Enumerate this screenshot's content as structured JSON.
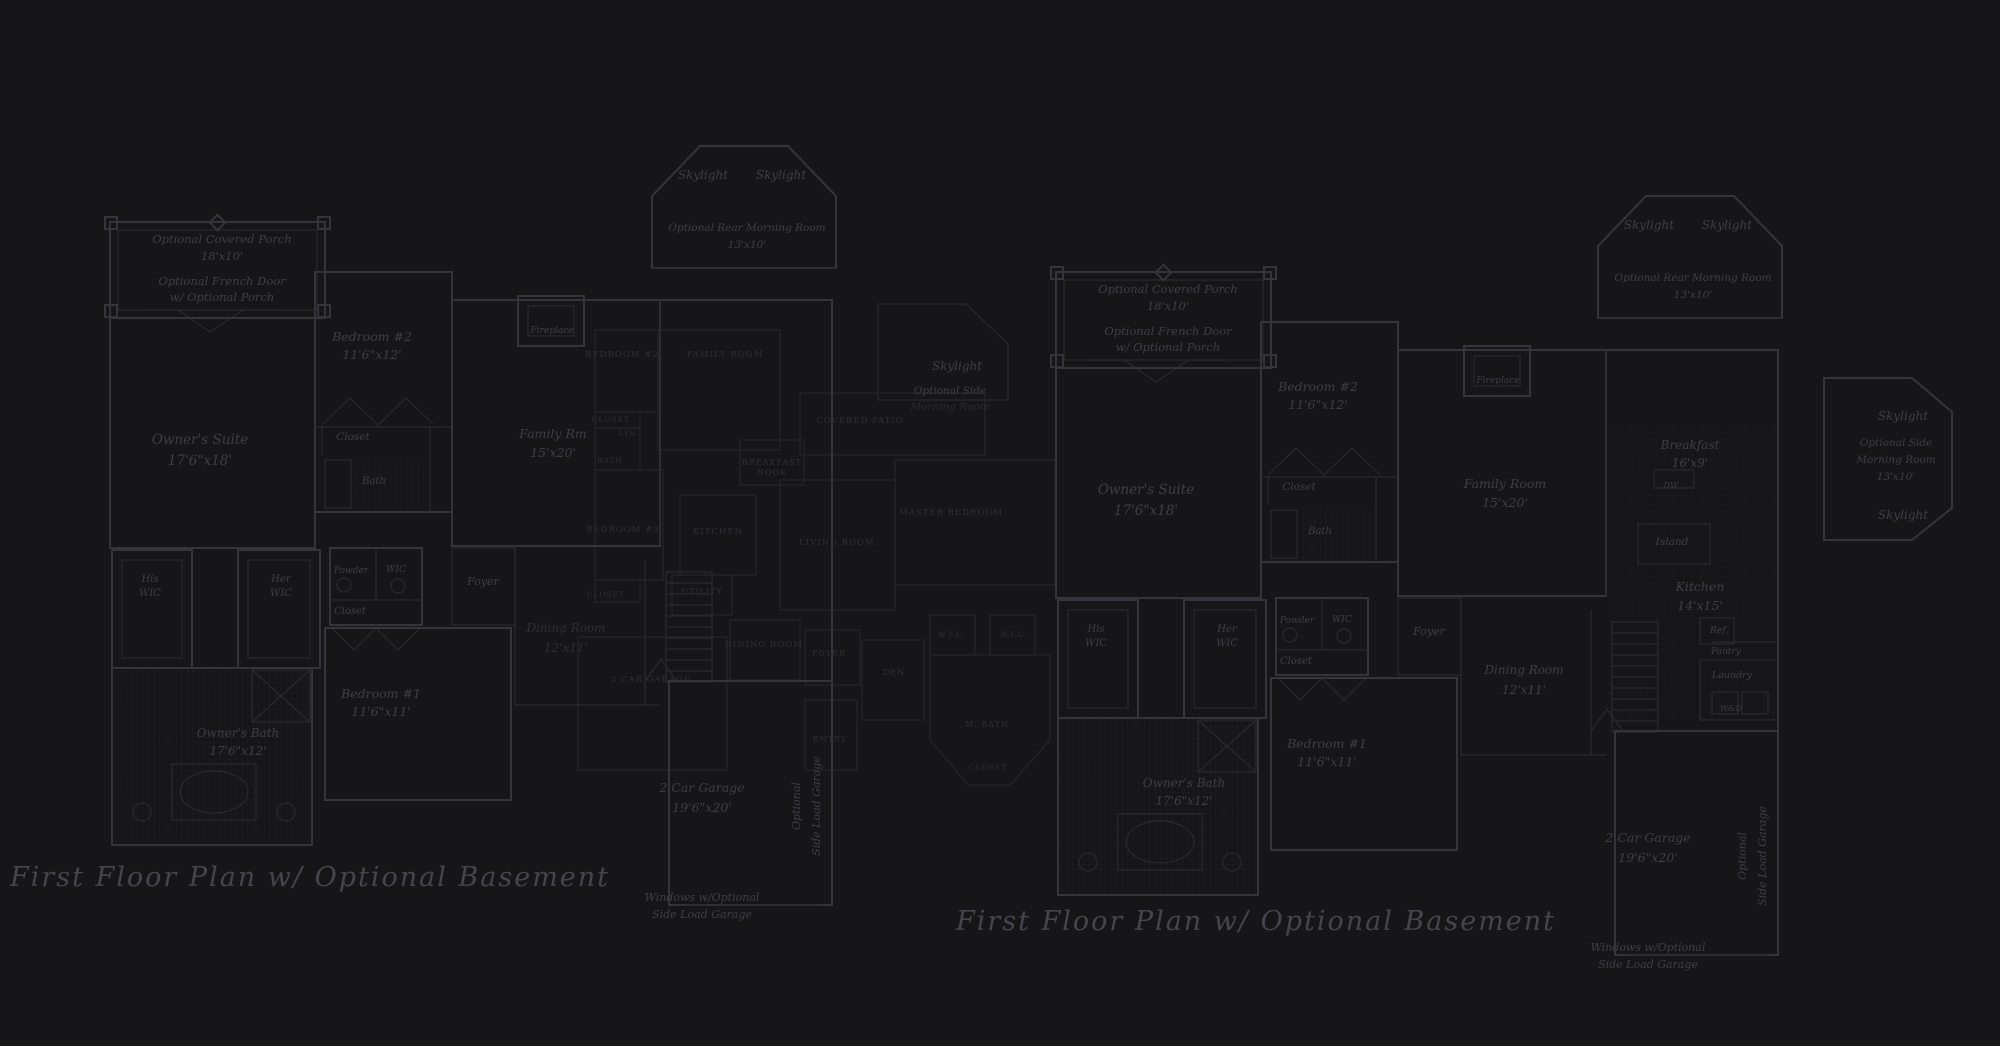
{
  "colors": {
    "background": "#161618",
    "wall": "#34343a",
    "thin": "#2a2a2e",
    "grid": "#222226",
    "bgline": "#26262b",
    "bgtext": "#32323a",
    "label": "#3f3e46",
    "caption": "#46454e"
  },
  "plans": {
    "left": {
      "caption": "First Floor Plan  w/ Optional Basement",
      "labels": [
        {
          "name": "optional-covered-porch-line1",
          "text": "Optional Covered Porch",
          "x": 222,
          "y": 243,
          "size": 11.5
        },
        {
          "name": "optional-covered-porch-line2",
          "text": "18'x10'",
          "x": 222,
          "y": 260,
          "size": 11.5
        },
        {
          "name": "optional-french-door-line1",
          "text": "Optional French Door",
          "x": 222,
          "y": 285,
          "size": 11.5
        },
        {
          "name": "optional-french-door-line2",
          "text": "w/ Optional Porch",
          "x": 222,
          "y": 301,
          "size": 11.5
        },
        {
          "name": "bedroom-2-line1",
          "text": "Bedroom #2",
          "x": 372,
          "y": 341,
          "size": 12.5
        },
        {
          "name": "bedroom-2-line2",
          "text": "11'6\"x12'",
          "x": 372,
          "y": 359,
          "size": 12.5
        },
        {
          "name": "owners-suite-line1",
          "text": "Owner's Suite",
          "x": 200,
          "y": 444,
          "size": 13.5
        },
        {
          "name": "owners-suite-line2",
          "text": "17'6\"x18'",
          "x": 200,
          "y": 465,
          "size": 13.5
        },
        {
          "name": "closet-bedroom2",
          "text": "Closet",
          "x": 353,
          "y": 440,
          "size": 10.5
        },
        {
          "name": "bath-bedroom2",
          "text": "Bath",
          "x": 374,
          "y": 484,
          "size": 10
        },
        {
          "name": "family-rm-line1",
          "text": "Family Rm",
          "x": 553,
          "y": 438,
          "size": 12.5
        },
        {
          "name": "family-rm-line2",
          "text": "15'x20'",
          "x": 553,
          "y": 457,
          "size": 12.5
        },
        {
          "name": "fireplace",
          "text": "Fireplace",
          "x": 552,
          "y": 333,
          "size": 9
        },
        {
          "name": "skylight-rear-left",
          "text": "Skylight",
          "x": 703,
          "y": 179,
          "size": 12
        },
        {
          "name": "skylight-rear-right",
          "text": "Skylight",
          "x": 781,
          "y": 179,
          "size": 12
        },
        {
          "name": "optional-rear-morning-room-line1",
          "text": "Optional Rear Morning Room",
          "x": 747,
          "y": 231,
          "size": 10.5
        },
        {
          "name": "optional-rear-morning-room-line2",
          "text": "13'x10'",
          "x": 747,
          "y": 248,
          "size": 10.5
        },
        {
          "name": "skylight-side",
          "text": "Skylight",
          "x": 957,
          "y": 370,
          "size": 12
        },
        {
          "name": "optional-side-morning-room-line1",
          "text": "Optional Side",
          "x": 950,
          "y": 394,
          "size": 10.5
        },
        {
          "name": "optional-side-morning-room-line2",
          "text": "Morning Room",
          "x": 950,
          "y": 410,
          "size": 10.5,
          "opacity": 0.5
        },
        {
          "name": "his-wic-line1",
          "text": "His",
          "x": 150,
          "y": 582,
          "size": 10
        },
        {
          "name": "his-wic-line2",
          "text": "WIC",
          "x": 150,
          "y": 596,
          "size": 10
        },
        {
          "name": "her-wic-line1",
          "text": "Her",
          "x": 281,
          "y": 582,
          "size": 10
        },
        {
          "name": "her-wic-line2",
          "text": "WIC",
          "x": 281,
          "y": 596,
          "size": 10
        },
        {
          "name": "powder",
          "text": "Powder",
          "x": 351,
          "y": 573,
          "size": 9
        },
        {
          "name": "wic-hall",
          "text": "WIC",
          "x": 396,
          "y": 572,
          "size": 9
        },
        {
          "name": "closet-hall",
          "text": "Closet",
          "x": 350,
          "y": 614,
          "size": 10
        },
        {
          "name": "foyer",
          "text": "Foyer",
          "x": 483,
          "y": 585,
          "size": 11
        },
        {
          "name": "dining-room-line1",
          "text": "Dining Room",
          "x": 566,
          "y": 632,
          "size": 12,
          "opacity": 0.6
        },
        {
          "name": "dining-room-line2",
          "text": "12'x11'",
          "x": 566,
          "y": 652,
          "size": 12,
          "opacity": 0.6
        },
        {
          "name": "bedroom-1-line1",
          "text": "Bedroom #1",
          "x": 381,
          "y": 698,
          "size": 12.5
        },
        {
          "name": "bedroom-1-line2",
          "text": "11'6\"x11'",
          "x": 381,
          "y": 716,
          "size": 12.5
        },
        {
          "name": "owners-bath-line1",
          "text": "Owner's Bath",
          "x": 238,
          "y": 737,
          "size": 12
        },
        {
          "name": "owners-bath-line2",
          "text": "17'6\"x12'",
          "x": 238,
          "y": 755,
          "size": 12
        },
        {
          "name": "garage-line1",
          "text": "2 Car Garage",
          "x": 702,
          "y": 792,
          "size": 12.5
        },
        {
          "name": "garage-line2",
          "text": "19'6\"x20'",
          "x": 702,
          "y": 812,
          "size": 12.5
        },
        {
          "name": "optional-side-load-garage-line1",
          "text": "Optional",
          "x": 800,
          "y": 806,
          "size": 11,
          "rotate": -90
        },
        {
          "name": "optional-side-load-garage-line2",
          "text": "Side Load Garage",
          "x": 820,
          "y": 806,
          "size": 11,
          "rotate": -90
        },
        {
          "name": "windows-side-load-line1",
          "text": "Windows w/Optional",
          "x": 702,
          "y": 901,
          "size": 11
        },
        {
          "name": "windows-side-load-line2",
          "text": "Side Load Garage",
          "x": 702,
          "y": 918,
          "size": 11
        },
        {
          "name": "plan-caption",
          "text": "First Floor Plan  w/ Optional Basement",
          "x": 310,
          "y": 886,
          "size": 27,
          "caption": true
        }
      ]
    },
    "right": {
      "caption": "First Floor Plan  w/ Optional Basement",
      "labels": [
        {
          "name": "optional-covered-porch-line1",
          "text": "Optional Covered Porch",
          "x": 1168,
          "y": 293,
          "size": 11.5
        },
        {
          "name": "optional-covered-porch-line2",
          "text": "18'x10'",
          "x": 1168,
          "y": 310,
          "size": 11.5
        },
        {
          "name": "optional-french-door-line1",
          "text": "Optional French Door",
          "x": 1168,
          "y": 335,
          "size": 11.5
        },
        {
          "name": "optional-french-door-line2",
          "text": "w/ Optional Porch",
          "x": 1168,
          "y": 351,
          "size": 11.5
        },
        {
          "name": "bedroom-2-line1",
          "text": "Bedroom #2",
          "x": 1318,
          "y": 391,
          "size": 12.5
        },
        {
          "name": "bedroom-2-line2",
          "text": "11'6\"x12'",
          "x": 1318,
          "y": 409,
          "size": 12.5
        },
        {
          "name": "owners-suite-line1",
          "text": "Owner's Suite",
          "x": 1146,
          "y": 494,
          "size": 13.5
        },
        {
          "name": "owners-suite-line2",
          "text": "17'6\"x18'",
          "x": 1146,
          "y": 515,
          "size": 13.5
        },
        {
          "name": "closet-bedroom2",
          "text": "Closet",
          "x": 1299,
          "y": 490,
          "size": 10.5
        },
        {
          "name": "bath-bedroom2",
          "text": "Bath",
          "x": 1320,
          "y": 534,
          "size": 10
        },
        {
          "name": "family-room-line1",
          "text": "Family Room",
          "x": 1505,
          "y": 488,
          "size": 12.5
        },
        {
          "name": "family-room-line2",
          "text": "15'x20'",
          "x": 1505,
          "y": 507,
          "size": 12.5
        },
        {
          "name": "fireplace",
          "text": "Fireplace",
          "x": 1498,
          "y": 383,
          "size": 9
        },
        {
          "name": "skylight-rear-left",
          "text": "Skylight",
          "x": 1649,
          "y": 229,
          "size": 12
        },
        {
          "name": "skylight-rear-right",
          "text": "Skylight",
          "x": 1727,
          "y": 229,
          "size": 12
        },
        {
          "name": "optional-rear-morning-room-line1",
          "text": "Optional Rear Morning Room",
          "x": 1693,
          "y": 281,
          "size": 10.5
        },
        {
          "name": "optional-rear-morning-room-line2",
          "text": "13'x10'",
          "x": 1693,
          "y": 298,
          "size": 10.5
        },
        {
          "name": "skylight-side-top",
          "text": "Skylight",
          "x": 1903,
          "y": 420,
          "size": 12
        },
        {
          "name": "optional-side-morning-room-line1",
          "text": "Optional Side",
          "x": 1896,
          "y": 446,
          "size": 10.5
        },
        {
          "name": "optional-side-morning-room-line2",
          "text": "Morning Room",
          "x": 1896,
          "y": 463,
          "size": 10.5
        },
        {
          "name": "optional-side-morning-room-line3",
          "text": "13'x10'",
          "x": 1896,
          "y": 480,
          "size": 10.5
        },
        {
          "name": "skylight-side-bottom",
          "text": "Skylight",
          "x": 1903,
          "y": 519,
          "size": 12
        },
        {
          "name": "breakfast-line1",
          "text": "Breakfast",
          "x": 1690,
          "y": 449,
          "size": 12
        },
        {
          "name": "breakfast-line2",
          "text": "16'x9'",
          "x": 1690,
          "y": 467,
          "size": 12
        },
        {
          "name": "dw",
          "text": "DW",
          "x": 1671,
          "y": 488,
          "size": 8
        },
        {
          "name": "island",
          "text": "Island",
          "x": 1672,
          "y": 545,
          "size": 10.5
        },
        {
          "name": "kitchen-line1",
          "text": "Kitchen",
          "x": 1700,
          "y": 591,
          "size": 12.5
        },
        {
          "name": "kitchen-line2",
          "text": "14'x15'",
          "x": 1700,
          "y": 610,
          "size": 12.5
        },
        {
          "name": "ref",
          "text": "Ref.",
          "x": 1719,
          "y": 633,
          "size": 9
        },
        {
          "name": "pantry",
          "text": "Pantry",
          "x": 1726,
          "y": 654,
          "size": 9
        },
        {
          "name": "laundry",
          "text": "Laundry",
          "x": 1732,
          "y": 678,
          "size": 9.5
        },
        {
          "name": "wd",
          "text": "W&D",
          "x": 1731,
          "y": 711,
          "size": 8
        },
        {
          "name": "his-wic-line1",
          "text": "His",
          "x": 1096,
          "y": 632,
          "size": 10
        },
        {
          "name": "his-wic-line2",
          "text": "WIC",
          "x": 1096,
          "y": 646,
          "size": 10
        },
        {
          "name": "her-wic-line1",
          "text": "Her",
          "x": 1227,
          "y": 632,
          "size": 10
        },
        {
          "name": "her-wic-line2",
          "text": "WIC",
          "x": 1227,
          "y": 646,
          "size": 10
        },
        {
          "name": "powder",
          "text": "Powder",
          "x": 1297,
          "y": 623,
          "size": 9
        },
        {
          "name": "wic-hall",
          "text": "WIC",
          "x": 1342,
          "y": 622,
          "size": 9
        },
        {
          "name": "closet-hall",
          "text": "Closet",
          "x": 1296,
          "y": 664,
          "size": 10
        },
        {
          "name": "foyer",
          "text": "Foyer",
          "x": 1429,
          "y": 635,
          "size": 11
        },
        {
          "name": "dining-room-line1",
          "text": "Dining Room",
          "x": 1524,
          "y": 674,
          "size": 12
        },
        {
          "name": "dining-room-line2",
          "text": "12'x11'",
          "x": 1524,
          "y": 694,
          "size": 12
        },
        {
          "name": "bedroom-1-line1",
          "text": "Bedroom #1",
          "x": 1327,
          "y": 748,
          "size": 12.5
        },
        {
          "name": "bedroom-1-line2",
          "text": "11'6\"x11'",
          "x": 1327,
          "y": 766,
          "size": 12.5
        },
        {
          "name": "owners-bath-line1",
          "text": "Owner's Bath",
          "x": 1184,
          "y": 787,
          "size": 12
        },
        {
          "name": "owners-bath-line2",
          "text": "17'6\"x12'",
          "x": 1184,
          "y": 805,
          "size": 12
        },
        {
          "name": "garage-line1",
          "text": "2 Car Garage",
          "x": 1648,
          "y": 842,
          "size": 12.5
        },
        {
          "name": "garage-line2",
          "text": "19'6\"x20'",
          "x": 1648,
          "y": 862,
          "size": 12.5
        },
        {
          "name": "optional-side-load-garage-line1",
          "text": "Optional",
          "x": 1746,
          "y": 856,
          "size": 11,
          "rotate": -90
        },
        {
          "name": "optional-side-load-garage-line2",
          "text": "Side Load Garage",
          "x": 1766,
          "y": 856,
          "size": 11,
          "rotate": -90
        },
        {
          "name": "windows-side-load-line1",
          "text": "Windows w/Optional",
          "x": 1648,
          "y": 951,
          "size": 11
        },
        {
          "name": "windows-side-load-line2",
          "text": "Side Load Garage",
          "x": 1648,
          "y": 968,
          "size": 11
        },
        {
          "name": "plan-caption",
          "text": "First Floor Plan  w/ Optional Basement",
          "x": 1256,
          "y": 930,
          "size": 27,
          "caption": true
        }
      ]
    },
    "background": {
      "labels": [
        {
          "name": "bg-bedroom-2",
          "text": "BEDROOM #2",
          "x": 622,
          "y": 357,
          "size": 8.5
        },
        {
          "name": "bg-family-room",
          "text": "FAMILY ROOM",
          "x": 725,
          "y": 357,
          "size": 8.5
        },
        {
          "name": "bg-closet-1",
          "text": "CLOSET",
          "x": 611,
          "y": 422,
          "size": 7.5
        },
        {
          "name": "bg-lin",
          "text": "LIN.",
          "x": 629,
          "y": 436,
          "size": 7.5
        },
        {
          "name": "bg-bath",
          "text": "BATH",
          "x": 610,
          "y": 463,
          "size": 7.5
        },
        {
          "name": "bg-breakfast-line1",
          "text": "BREAKFAST",
          "x": 772,
          "y": 465,
          "size": 8
        },
        {
          "name": "bg-breakfast-line2",
          "text": "NOOK",
          "x": 772,
          "y": 475,
          "size": 8
        },
        {
          "name": "bg-covered-patio",
          "text": "COVERED PATIO",
          "x": 860,
          "y": 423,
          "size": 8.5
        },
        {
          "name": "bg-master-bedroom",
          "text": "MASTER BEDROOM",
          "x": 951,
          "y": 515,
          "size": 8.5
        },
        {
          "name": "bg-bedroom-3",
          "text": "BEDROOM #3",
          "x": 623,
          "y": 532,
          "size": 8.5
        },
        {
          "name": "bg-kitchen",
          "text": "KITCHEN",
          "x": 718,
          "y": 534,
          "size": 8.5
        },
        {
          "name": "bg-living-room",
          "text": "LIVING ROOM",
          "x": 837,
          "y": 545,
          "size": 8.5
        },
        {
          "name": "bg-closet-2",
          "text": "CLOSET",
          "x": 606,
          "y": 597,
          "size": 7.5
        },
        {
          "name": "bg-utility",
          "text": "UTILITY",
          "x": 702,
          "y": 594,
          "size": 8
        },
        {
          "name": "bg-wic-1",
          "text": "W.I.C.",
          "x": 952,
          "y": 637,
          "size": 7.5
        },
        {
          "name": "bg-wic-2",
          "text": "W.I.C.",
          "x": 1014,
          "y": 637,
          "size": 7.5
        },
        {
          "name": "bg-dining-room",
          "text": "DINING ROOM",
          "x": 764,
          "y": 647,
          "size": 8.5
        },
        {
          "name": "bg-foyer",
          "text": "FOYER",
          "x": 829,
          "y": 656,
          "size": 8
        },
        {
          "name": "bg-den",
          "text": "DEN",
          "x": 894,
          "y": 675,
          "size": 8
        },
        {
          "name": "bg-2-car-garage",
          "text": "2 CAR GARAGE",
          "x": 651,
          "y": 682,
          "size": 8.5
        },
        {
          "name": "bg-m-bath",
          "text": "M. BATH",
          "x": 987,
          "y": 727,
          "size": 8
        },
        {
          "name": "bg-entry",
          "text": "ENTRY",
          "x": 830,
          "y": 742,
          "size": 8
        },
        {
          "name": "bg-closet-3",
          "text": "CLOSET",
          "x": 988,
          "y": 770,
          "size": 7.5
        }
      ]
    }
  }
}
